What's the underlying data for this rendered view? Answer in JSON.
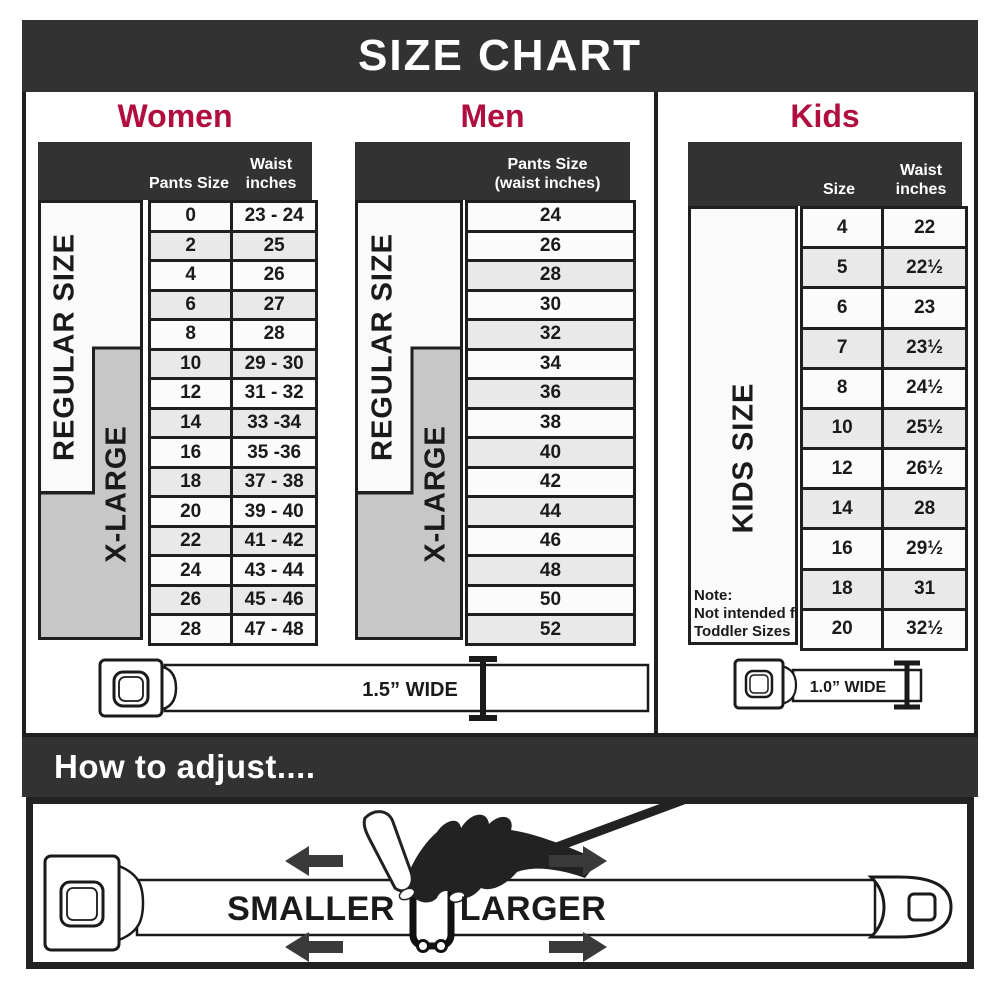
{
  "title": "SIZE CHART",
  "colors": {
    "banner": "#323232",
    "accent": "#b00e3e",
    "xlarge_box": "#c7c7c7"
  },
  "women": {
    "heading": "Women",
    "col1": "Pants Size",
    "col2_line1": "Waist",
    "col2_line2": "inches",
    "regular_label": "REGULAR SIZE",
    "xlarge_label": "X-LARGE",
    "rows": [
      {
        "size": "0",
        "waist": "23 - 24"
      },
      {
        "size": "2",
        "waist": "25"
      },
      {
        "size": "4",
        "waist": "26"
      },
      {
        "size": "6",
        "waist": "27"
      },
      {
        "size": "8",
        "waist": "28"
      },
      {
        "size": "10",
        "waist": "29 - 30"
      },
      {
        "size": "12",
        "waist": "31 - 32"
      },
      {
        "size": "14",
        "waist": "33 -34"
      },
      {
        "size": "16",
        "waist": "35 -36"
      },
      {
        "size": "18",
        "waist": "37 - 38"
      },
      {
        "size": "20",
        "waist": "39 - 40"
      },
      {
        "size": "22",
        "waist": "41 - 42"
      },
      {
        "size": "24",
        "waist": "43 - 44"
      },
      {
        "size": "26",
        "waist": "45 - 46"
      },
      {
        "size": "28",
        "waist": "47 - 48"
      }
    ]
  },
  "men": {
    "heading": "Men",
    "col1_line1": "Pants Size",
    "col1_line2": "(waist inches)",
    "regular_label": "REGULAR SIZE",
    "xlarge_label": "X-LARGE",
    "rows": [
      "24",
      "26",
      "28",
      "30",
      "32",
      "34",
      "36",
      "38",
      "40",
      "42",
      "44",
      "46",
      "48",
      "50",
      "52"
    ]
  },
  "kids": {
    "heading": "Kids",
    "col1": "Size",
    "col2_line1": "Waist",
    "col2_line2": "inches",
    "label": "KIDS SIZE",
    "note_lines": [
      "Note:",
      "Not intended for",
      "Toddler Sizes (T)"
    ],
    "rows": [
      {
        "size": "4",
        "waist": "22"
      },
      {
        "size": "5",
        "waist": "22½"
      },
      {
        "size": "6",
        "waist": "23"
      },
      {
        "size": "7",
        "waist": "23½"
      },
      {
        "size": "8",
        "waist": "24½"
      },
      {
        "size": "10",
        "waist": "25½"
      },
      {
        "size": "12",
        "waist": "26½"
      },
      {
        "size": "14",
        "waist": "28"
      },
      {
        "size": "16",
        "waist": "29½"
      },
      {
        "size": "18",
        "waist": "31"
      },
      {
        "size": "20",
        "waist": "32½"
      }
    ]
  },
  "belts": {
    "adult_width_label": "1.5” WIDE",
    "kids_width_label": "1.0” WIDE"
  },
  "adjust": {
    "heading": "How to adjust....",
    "smaller_label": "SMALLER",
    "larger_label": "LARGER"
  }
}
